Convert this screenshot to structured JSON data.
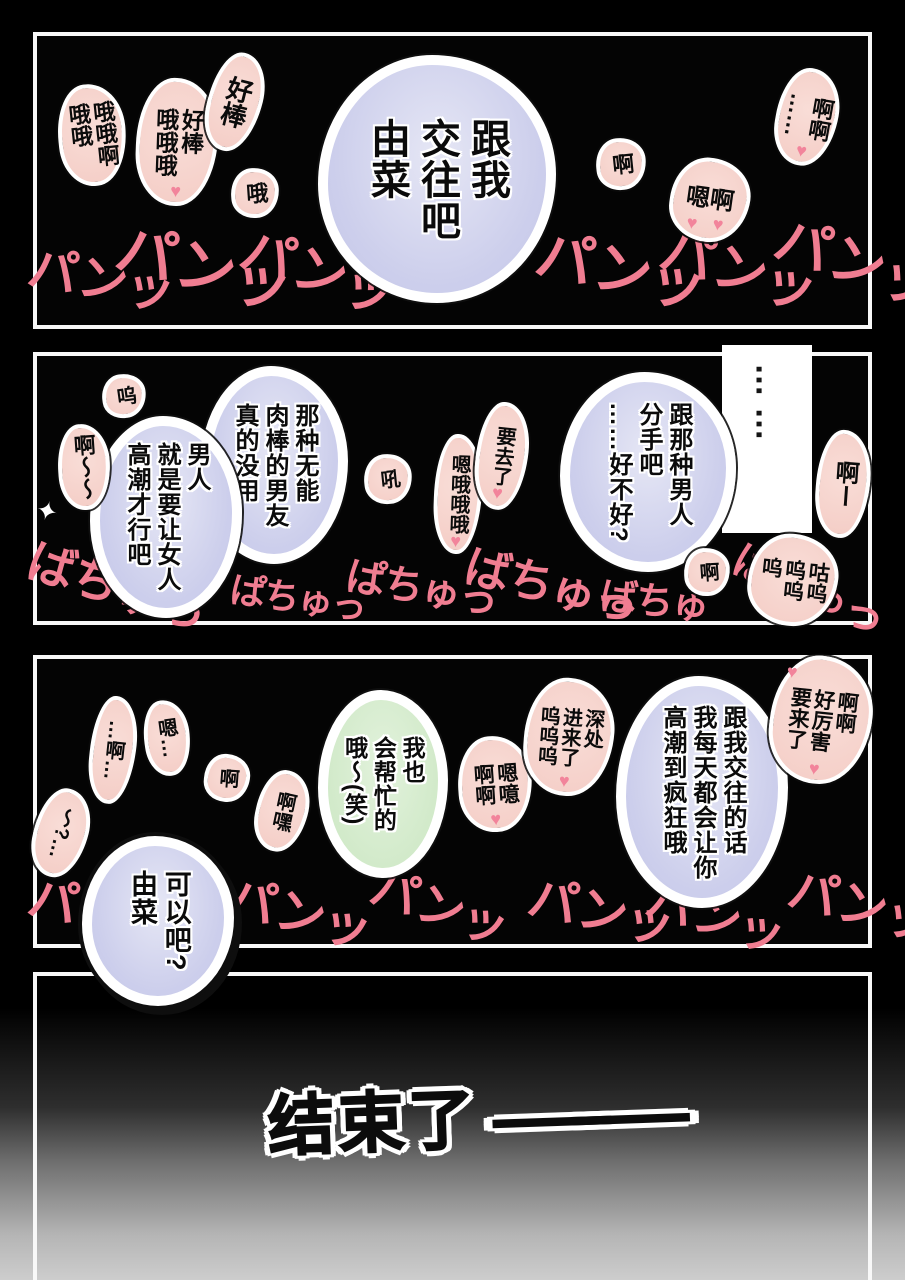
{
  "symbols": {
    "heart": "♥",
    "sparkle": "✦"
  },
  "panel1": {
    "bubble": {
      "text": "跟我\n交往吧\n由菜"
    },
    "bursts": [
      {
        "text": "哦哦啊\n哦哦"
      },
      {
        "text": "好棒\n哦哦哦"
      },
      {
        "text": "好棒"
      },
      {
        "text": "哦"
      },
      {
        "text": "啊"
      },
      {
        "text": "嗯啊"
      },
      {
        "text": "啊啊\n……"
      }
    ],
    "sfx": [
      "パンッ",
      "パンッ",
      "パンッ",
      "パンッ",
      "パンッ",
      "パンッ"
    ]
  },
  "panel2": {
    "silence_dots": "……",
    "bubbles": [
      {
        "text": "那种无能\n肉棒的男友\n真的没用"
      },
      {
        "text": "男人\n就是要让女人\n高潮才行吧"
      },
      {
        "text": "跟那种男人\n分手吧\n……好不好?"
      }
    ],
    "bursts": [
      {
        "text": "呜"
      },
      {
        "text": "啊〜〜"
      },
      {
        "text": "吼"
      },
      {
        "text": "嗯哦哦哦"
      },
      {
        "text": "要去了"
      },
      {
        "text": "啊"
      },
      {
        "text": "咕呜\n呜呜\n呜"
      },
      {
        "text": "啊ー"
      }
    ],
    "sfx": [
      "ばちゅっ",
      "ぱちゅっ",
      "ぱちゅっ",
      "ばちゅっ",
      "ばちゅ",
      "ばちゅっ"
    ]
  },
  "panel3": {
    "bubbles": [
      {
        "text": "跟我交往的话\n我每天都会让你\n高潮到疯狂哦"
      },
      {
        "text": "我也\n会帮忙的\n哦〜(笑)"
      },
      {
        "text": "可以吧?\n由菜"
      }
    ],
    "bursts": [
      {
        "text": "嗯噫\n啊啊"
      },
      {
        "text": "深处\n进来了\n呜呜呜"
      },
      {
        "text": "啊啊\n好厉害\n要来了"
      },
      {
        "text": "〜?…"
      },
      {
        "text": "…啊…"
      },
      {
        "text": "嗯…"
      },
      {
        "text": "啊"
      },
      {
        "text": "啊嘿"
      }
    ],
    "sfx": [
      "パンッ",
      "パンッ",
      "パンッ",
      "パンッ",
      "パンッ",
      "パンッ"
    ]
  },
  "panel4": {
    "ending": "结束了",
    "dash": "——"
  }
}
